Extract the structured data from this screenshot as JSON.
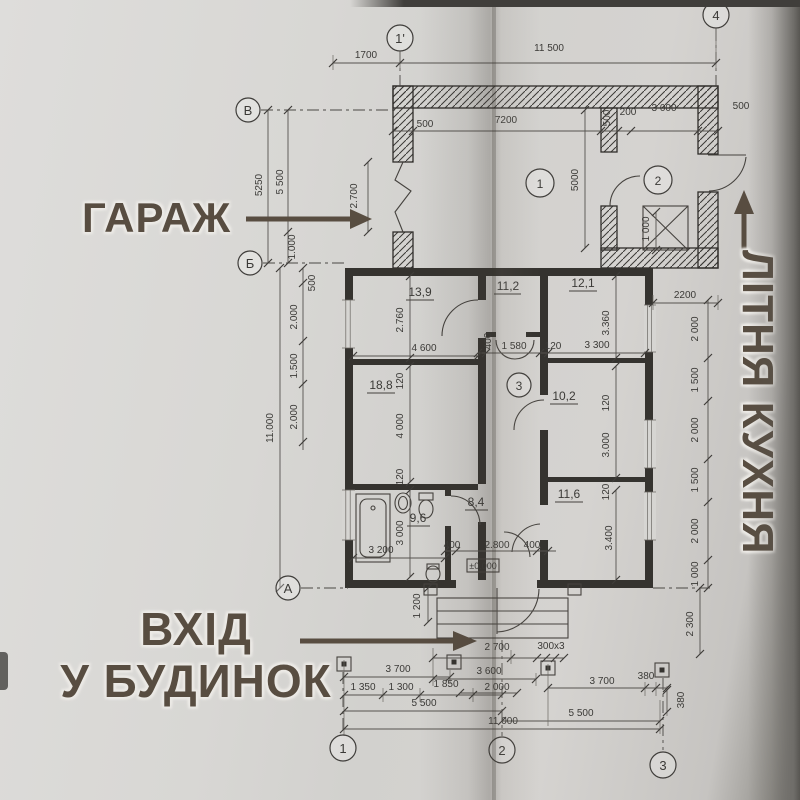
{
  "big_labels": {
    "garage": "ГАРАЖ",
    "summer_kitchen": "ЛІТНЯ КУХНЯ",
    "entrance1": "ВХІД",
    "entrance2": "У БУДИНОК"
  },
  "axes": {
    "top_left": "1'",
    "top_right": "4",
    "left_top": "В",
    "left_mid": "Б",
    "left_bot": "А",
    "bot_1": "1",
    "bot_2": "2",
    "bot_3": "3"
  },
  "room_numbers": {
    "garage": "1",
    "kitchen": "2",
    "hall": "3"
  },
  "areas": {
    "r139": "13,9",
    "r112": "11,2",
    "r121": "12,1",
    "r188": "18,8",
    "r102": "10,2",
    "r96": "9,6",
    "r84": "8,4",
    "r116": "11,6"
  },
  "elevation": "±0.000",
  "dims": {
    "t1700": "1700",
    "t11500": "11 500",
    "g500a": "500",
    "g7200": "7200",
    "g500v": "500",
    "g200": "200",
    "g3000": "3 000",
    "g500b": "500",
    "g5000": "5000",
    "g2700": "2.700",
    "g1000a": "1.000",
    "g1000b": "1 000",
    "l5250": "5250",
    "l5500": "5 500",
    "lh500": "500",
    "lh2000a": "2.000",
    "lh1500": "1.500",
    "lh2000b": "2.000",
    "lh11000": "11.000",
    "i2760": "2.760",
    "i4600": "4 600",
    "i120a": "120",
    "i4000": "4 000",
    "i120b": "120",
    "i3000a": "3 000",
    "i3200": "3 200",
    "i400": "400",
    "i1580": "1 580",
    "i120c": "120",
    "i3300": "3 300",
    "i3360": "3.360",
    "i120d": "120",
    "i3000b": "3.000",
    "i120e": "120",
    "i3400": "3.400",
    "e400a": "400",
    "e2800": "2.800",
    "e400b": "400",
    "e1200": "1 200",
    "e2700": "2 700",
    "steps": "300x3",
    "r2200": "2200",
    "r2000a": "2 000",
    "r1500a": "1 500",
    "r2000b": "2 000",
    "r1500b": "1 500",
    "r2000c": "2 000",
    "r1000": "1 000",
    "r2300": "2 300",
    "b3700a": "3 700",
    "b1350": "1 350",
    "b1300": "1 300",
    "b1850": "1 850",
    "b5500a": "5 500",
    "b11000": "11 000",
    "b3600": "3 600",
    "b2000": "2 000",
    "b3700b": "3 700",
    "b380a": "380",
    "b380b": "380",
    "b5500b": "5 500"
  }
}
